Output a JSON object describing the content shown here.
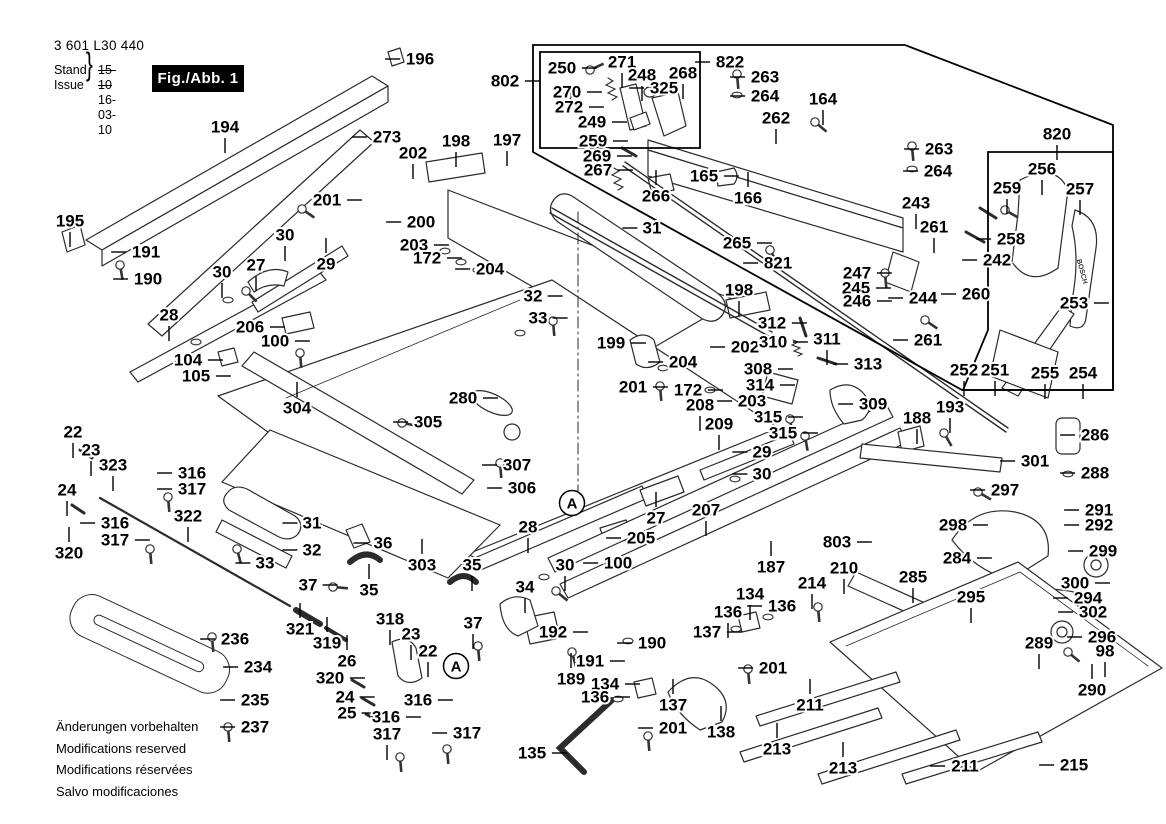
{
  "header": {
    "part_number": "3 601 L30 440",
    "stand_label": "Stand",
    "issue_label": "Issue",
    "brace": "}",
    "date_old": "15-10",
    "date_new": "16-03-10",
    "fig_label": "Fig./Abb. 1"
  },
  "footer_notes": [
    "Änderungen vorbehalten",
    "Modifications reserved",
    "Modifications réservées",
    "Salvo modificaciones"
  ],
  "knob_brand": "BOSCH",
  "colors": {
    "ink": "#000000",
    "art_line": "#2b2b2b",
    "background": "#ffffff",
    "fig_box_bg": "#000000",
    "fig_box_text": "#ffffff"
  },
  "a_markers": [
    {
      "x": 572,
      "y": 503
    },
    {
      "x": 456,
      "y": 666
    }
  ],
  "fasteners": {
    "screws": [
      [
        590,
        70,
        -25
      ],
      [
        567,
        96,
        -25
      ],
      [
        120,
        265,
        80
      ],
      [
        815,
        122,
        40
      ],
      [
        912,
        146,
        85
      ],
      [
        737,
        74,
        85
      ],
      [
        302,
        209,
        35
      ],
      [
        246,
        291,
        45
      ],
      [
        553,
        321,
        85
      ],
      [
        300,
        353,
        85
      ],
      [
        660,
        386,
        85
      ],
      [
        402,
        423,
        10
      ],
      [
        500,
        463,
        85
      ],
      [
        978,
        492,
        30
      ],
      [
        944,
        433,
        60
      ],
      [
        818,
        607,
        85
      ],
      [
        648,
        736,
        85
      ],
      [
        748,
        669,
        85
      ],
      [
        212,
        637,
        85
      ],
      [
        228,
        727,
        85
      ],
      [
        1068,
        652,
        40
      ],
      [
        572,
        652,
        75
      ],
      [
        447,
        749,
        85
      ],
      [
        400,
        757,
        85
      ],
      [
        168,
        497,
        85
      ],
      [
        150,
        549,
        85
      ],
      [
        237,
        549,
        75
      ],
      [
        333,
        587,
        5
      ],
      [
        478,
        646,
        85
      ],
      [
        556,
        591,
        40
      ],
      [
        885,
        273,
        85
      ],
      [
        790,
        419,
        80
      ],
      [
        805,
        436,
        80
      ],
      [
        925,
        320,
        35
      ],
      [
        1005,
        210,
        30
      ],
      [
        770,
        250,
        60
      ]
    ],
    "washers": [
      [
        142,
        252
      ],
      [
        628,
        641
      ],
      [
        710,
        390
      ],
      [
        663,
        368
      ],
      [
        445,
        251
      ],
      [
        461,
        262
      ],
      [
        478,
        270
      ],
      [
        912,
        169
      ],
      [
        737,
        95
      ],
      [
        768,
        617
      ],
      [
        736,
        629
      ],
      [
        618,
        699
      ],
      [
        1068,
        474
      ],
      [
        544,
        577
      ],
      [
        735,
        479
      ],
      [
        196,
        342
      ],
      [
        228,
        300
      ],
      [
        520,
        333
      ]
    ]
  },
  "labels": [
    [
      "194",
      225,
      127,
      "b"
    ],
    [
      "196",
      420,
      59,
      "l"
    ],
    [
      "273",
      387,
      137,
      "l"
    ],
    [
      "195",
      70,
      221,
      "b"
    ],
    [
      "191",
      146,
      252,
      "l"
    ],
    [
      "190",
      148,
      279,
      "l"
    ],
    [
      "202",
      413,
      153,
      "b"
    ],
    [
      "198",
      456,
      141,
      "b"
    ],
    [
      "197",
      507,
      140,
      "b"
    ],
    [
      "201",
      327,
      200,
      "r"
    ],
    [
      "30",
      285,
      235,
      "b"
    ],
    [
      "29",
      326,
      264,
      "t"
    ],
    [
      "27",
      256,
      265,
      "b"
    ],
    [
      "30",
      222,
      272,
      "b"
    ],
    [
      "28",
      169,
      315,
      "b"
    ],
    [
      "206",
      250,
      327,
      "r"
    ],
    [
      "100",
      275,
      341,
      "r"
    ],
    [
      "104",
      188,
      360,
      "r"
    ],
    [
      "105",
      196,
      376,
      "r"
    ],
    [
      "200",
      421,
      222,
      "l"
    ],
    [
      "203",
      414,
      245,
      "r"
    ],
    [
      "172",
      427,
      258,
      "r"
    ],
    [
      "204",
      490,
      269,
      "l"
    ],
    [
      "32",
      533,
      296,
      "r"
    ],
    [
      "33",
      538,
      318,
      "r"
    ],
    [
      "199",
      611,
      343,
      "r"
    ],
    [
      "31",
      652,
      228,
      "l"
    ],
    [
      "802",
      505,
      81,
      "r"
    ],
    [
      "250",
      562,
      68,
      "r"
    ],
    [
      "271",
      622,
      62,
      "b"
    ],
    [
      "248",
      642,
      75,
      "b"
    ],
    [
      "268",
      683,
      73,
      "b"
    ],
    [
      "325",
      664,
      88,
      "l"
    ],
    [
      "270",
      567,
      92,
      "r"
    ],
    [
      "272",
      569,
      107,
      "r"
    ],
    [
      "249",
      592,
      122,
      "r"
    ],
    [
      "259",
      593,
      141,
      "r"
    ],
    [
      "269",
      597,
      156,
      "r"
    ],
    [
      "267",
      598,
      170,
      "r"
    ],
    [
      "266",
      656,
      196,
      "t"
    ],
    [
      "822",
      730,
      62,
      "l"
    ],
    [
      "263",
      765,
      77,
      "l"
    ],
    [
      "264",
      765,
      96,
      "l"
    ],
    [
      "262",
      776,
      118,
      "b"
    ],
    [
      "164",
      823,
      99,
      "b"
    ],
    [
      "165",
      704,
      176,
      "r"
    ],
    [
      "166",
      748,
      198,
      "t"
    ],
    [
      "265",
      737,
      243,
      "r"
    ],
    [
      "821",
      778,
      263,
      "l"
    ],
    [
      "198",
      739,
      290,
      "b"
    ],
    [
      "202",
      745,
      347,
      "l"
    ],
    [
      "203",
      752,
      401,
      "l"
    ],
    [
      "204",
      683,
      362,
      "l"
    ],
    [
      "263",
      939,
      149,
      "l"
    ],
    [
      "264",
      938,
      171,
      "l"
    ],
    [
      "243",
      916,
      203,
      "b"
    ],
    [
      "261",
      934,
      227,
      "b"
    ],
    [
      "247",
      857,
      273,
      "r"
    ],
    [
      "245",
      856,
      288,
      "r"
    ],
    [
      "246",
      857,
      301,
      "r"
    ],
    [
      "244",
      923,
      298,
      "l"
    ],
    [
      "260",
      976,
      294,
      "l"
    ],
    [
      "261",
      928,
      340,
      "l"
    ],
    [
      "242",
      997,
      260,
      "l"
    ],
    [
      "820",
      1057,
      134,
      "b"
    ],
    [
      "256",
      1042,
      169,
      "b"
    ],
    [
      "259",
      1007,
      188,
      "b"
    ],
    [
      "257",
      1080,
      189,
      "b"
    ],
    [
      "258",
      1011,
      239,
      "l"
    ],
    [
      "253",
      1074,
      303,
      "r"
    ],
    [
      "252",
      964,
      370,
      "b"
    ],
    [
      "251",
      995,
      370,
      "b"
    ],
    [
      "255",
      1045,
      373,
      "b"
    ],
    [
      "254",
      1083,
      373,
      "b"
    ],
    [
      "312",
      772,
      323,
      "r"
    ],
    [
      "310",
      773,
      342,
      "r"
    ],
    [
      "311",
      827,
      339,
      "b"
    ],
    [
      "308",
      758,
      369,
      "r"
    ],
    [
      "314",
      760,
      385,
      "r"
    ],
    [
      "313",
      868,
      364,
      "l"
    ],
    [
      "309",
      873,
      404,
      "l"
    ],
    [
      "315",
      768,
      417,
      "r"
    ],
    [
      "315",
      783,
      433,
      "r"
    ],
    [
      "188",
      917,
      418,
      "b"
    ],
    [
      "193",
      950,
      407,
      "b"
    ],
    [
      "201",
      633,
      387,
      "r"
    ],
    [
      "172",
      688,
      390,
      "r"
    ],
    [
      "208",
      700,
      405,
      "b"
    ],
    [
      "209",
      719,
      424,
      "b"
    ],
    [
      "29",
      762,
      452,
      "l"
    ],
    [
      "30",
      762,
      474,
      "l"
    ],
    [
      "27",
      656,
      518,
      "t"
    ],
    [
      "207",
      706,
      510,
      "b"
    ],
    [
      "205",
      641,
      538,
      "l"
    ],
    [
      "100",
      618,
      563,
      "l"
    ],
    [
      "28",
      528,
      527,
      "b"
    ],
    [
      "187",
      771,
      567,
      "t"
    ],
    [
      "803",
      837,
      542,
      "r"
    ],
    [
      "210",
      844,
      568,
      "b"
    ],
    [
      "214",
      812,
      583,
      "b"
    ],
    [
      "304",
      297,
      408,
      "t"
    ],
    [
      "305",
      428,
      422,
      "l"
    ],
    [
      "280",
      463,
      398,
      "r"
    ],
    [
      "307",
      517,
      465,
      "l"
    ],
    [
      "306",
      522,
      488,
      "l"
    ],
    [
      "303",
      422,
      565,
      "t"
    ],
    [
      "322",
      188,
      516,
      "b"
    ],
    [
      "31",
      312,
      523,
      "l"
    ],
    [
      "32",
      312,
      550,
      "l"
    ],
    [
      "33",
      265,
      563,
      "l"
    ],
    [
      "36",
      383,
      543,
      "l"
    ],
    [
      "35",
      369,
      590,
      "t"
    ],
    [
      "37",
      308,
      585,
      "r"
    ],
    [
      "22",
      73,
      432,
      "b"
    ],
    [
      "23",
      91,
      450,
      "b"
    ],
    [
      "323",
      113,
      465,
      "b"
    ],
    [
      "24",
      67,
      490,
      "b"
    ],
    [
      "316",
      192,
      473,
      "l"
    ],
    [
      "317",
      192,
      489,
      "l"
    ],
    [
      "316",
      115,
      523,
      "l"
    ],
    [
      "317",
      115,
      540,
      "r"
    ],
    [
      "320",
      69,
      553,
      "t"
    ],
    [
      "236",
      235,
      639,
      "l"
    ],
    [
      "234",
      258,
      667,
      "l"
    ],
    [
      "235",
      255,
      700,
      "l"
    ],
    [
      "237",
      255,
      727,
      "l"
    ],
    [
      "321",
      300,
      629,
      "t"
    ],
    [
      "319",
      327,
      643,
      "t"
    ],
    [
      "26",
      347,
      661,
      "t"
    ],
    [
      "318",
      390,
      619,
      "b"
    ],
    [
      "23",
      411,
      634,
      "b"
    ],
    [
      "22",
      428,
      651,
      "b"
    ],
    [
      "320",
      330,
      678,
      "r"
    ],
    [
      "24",
      345,
      697,
      "r"
    ],
    [
      "25",
      347,
      713,
      "r"
    ],
    [
      "316",
      418,
      700,
      "r"
    ],
    [
      "316",
      386,
      717,
      "r"
    ],
    [
      "317",
      387,
      734,
      "b"
    ],
    [
      "317",
      467,
      733,
      "l"
    ],
    [
      "35",
      472,
      565,
      "b"
    ],
    [
      "34",
      525,
      587,
      "b"
    ],
    [
      "37",
      473,
      623,
      "b"
    ],
    [
      "30",
      565,
      565,
      "b"
    ],
    [
      "192",
      553,
      632,
      "r"
    ],
    [
      "190",
      652,
      643,
      "l"
    ],
    [
      "191",
      590,
      661,
      "r"
    ],
    [
      "189",
      571,
      679,
      "t"
    ],
    [
      "134",
      605,
      684,
      "r"
    ],
    [
      "136",
      595,
      697,
      "r"
    ],
    [
      "137",
      673,
      705,
      "t"
    ],
    [
      "201",
      673,
      728,
      "l"
    ],
    [
      "138",
      721,
      732,
      "t"
    ],
    [
      "135",
      532,
      753,
      "r"
    ],
    [
      "134",
      750,
      594,
      "b"
    ],
    [
      "136",
      728,
      612,
      "b"
    ],
    [
      "136",
      782,
      606,
      "l"
    ],
    [
      "137",
      707,
      632,
      "r"
    ],
    [
      "201",
      773,
      668,
      "l"
    ],
    [
      "286",
      1095,
      435,
      "l"
    ],
    [
      "288",
      1095,
      473,
      "l"
    ],
    [
      "301",
      1035,
      461,
      "l"
    ],
    [
      "297",
      1005,
      490,
      "l"
    ],
    [
      "298",
      953,
      525,
      "r"
    ],
    [
      "284",
      957,
      558,
      "r"
    ],
    [
      "291",
      1099,
      510,
      "l"
    ],
    [
      "292",
      1099,
      525,
      "l"
    ],
    [
      "299",
      1103,
      551,
      "l"
    ],
    [
      "300",
      1075,
      583,
      "r"
    ],
    [
      "294",
      1088,
      598,
      "l"
    ],
    [
      "302",
      1093,
      612,
      "l"
    ],
    [
      "295",
      971,
      597,
      "b"
    ],
    [
      "285",
      913,
      577,
      "b"
    ],
    [
      "296",
      1102,
      637,
      "l"
    ],
    [
      "289",
      1039,
      643,
      "b"
    ],
    [
      "98",
      1105,
      651,
      "b"
    ],
    [
      "290",
      1092,
      690,
      "t"
    ],
    [
      "215",
      1074,
      765,
      "l"
    ],
    [
      "211",
      965,
      766,
      "l"
    ],
    [
      "213",
      843,
      768,
      "t"
    ],
    [
      "213",
      777,
      749,
      "t"
    ],
    [
      "211",
      810,
      705,
      "t"
    ]
  ]
}
